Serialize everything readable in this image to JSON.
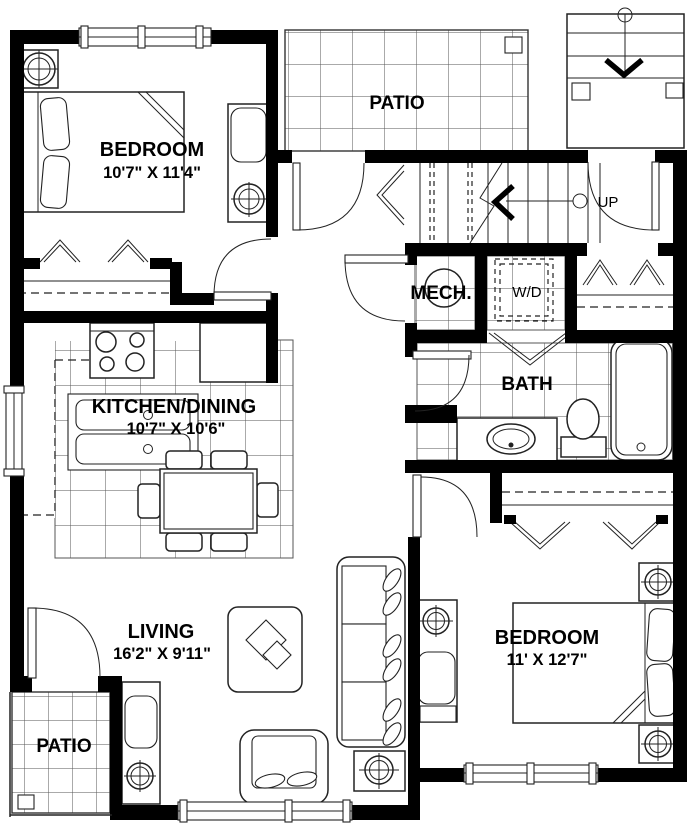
{
  "colors": {
    "wall": "#000000",
    "line": "#222222",
    "bg": "#ffffff"
  },
  "rooms": {
    "bedroom1": {
      "label": "BEDROOM",
      "dims": "10'7\" X 11'4\""
    },
    "patio_top": {
      "label": "PATIO"
    },
    "stairs": {
      "label": "UP"
    },
    "mech": {
      "label": "MECH."
    },
    "wd": {
      "label": "W/D"
    },
    "bath": {
      "label": "BATH"
    },
    "kitchen": {
      "label": "KITCHEN/DINING",
      "dims": "10'7\" X 10'6\""
    },
    "living": {
      "label": "LIVING",
      "dims": "16'2\" X 9'11\""
    },
    "patio_bottom": {
      "label": "PATIO"
    },
    "bedroom2": {
      "label": "BEDROOM",
      "dims": "11' X 12'7\""
    }
  }
}
